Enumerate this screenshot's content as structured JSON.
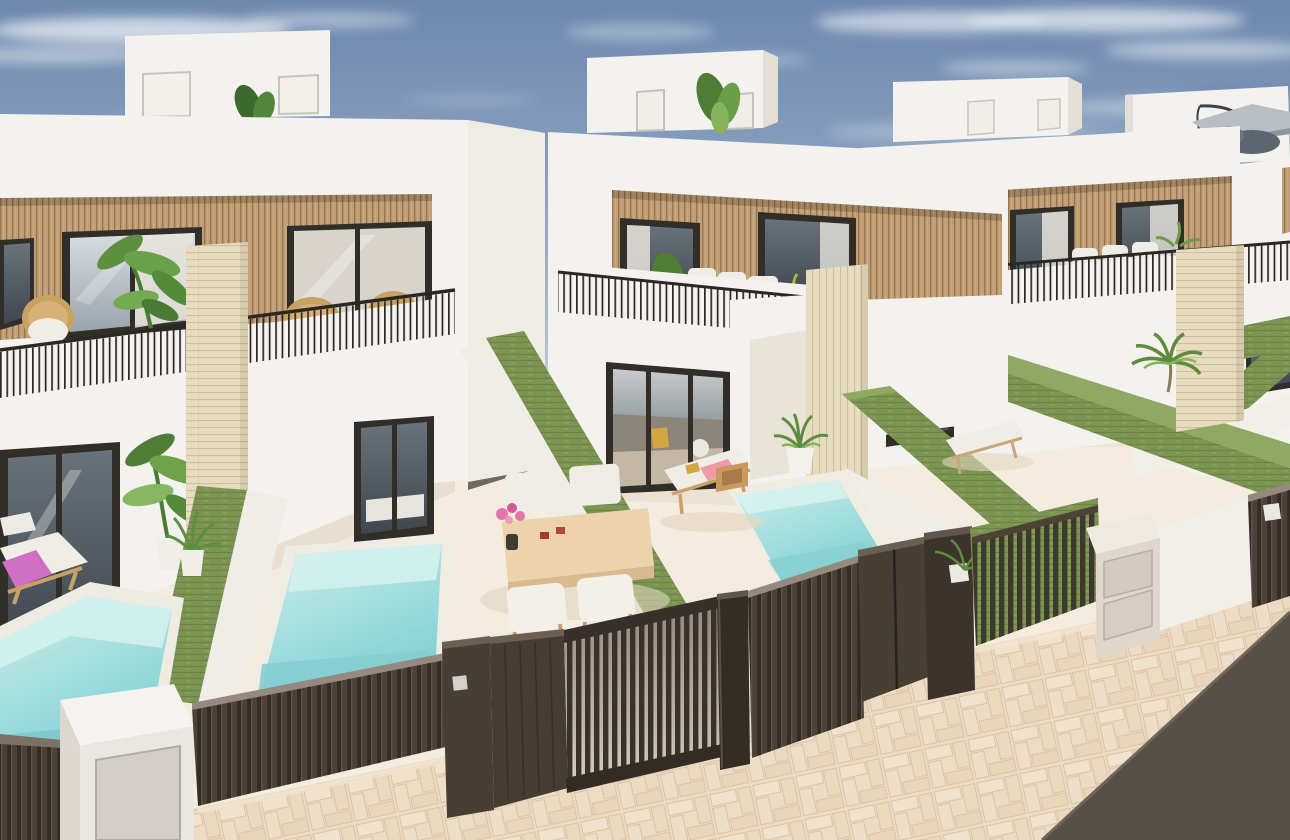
{
  "scene": {
    "type": "3d-architectural-render",
    "subject": "row of modern two-storey white villas with rooftop terraces, wooden slat facades, private plunge pools, green hedge walls, dark slatted street fence and gates, herringbone sidewalk and asphalt road",
    "palette": {
      "sky_top": "#6d88ae",
      "sky_mid": "#93a9c4",
      "sky_horizon": "#cdd4dc",
      "cloud": "#eef2f6",
      "cloud_shadow": "#5f7ba3",
      "wall_white": "#f4f2ee",
      "wall_shadow": "#e3dfd7",
      "wood_slat": "#bf9d75",
      "wood_slat_dark": "#97764f",
      "window_frame": "#312e29",
      "glass_light": "#d8dde1",
      "glass_dark": "#3f464d",
      "curtain": "#e6e3dc",
      "railing": "#2b2824",
      "travertine": "#e7dcc0",
      "travertine_line": "#d0bf9f",
      "hedge": "#7c9452",
      "hedge_dark": "#6a8244",
      "hedge_light": "#8fa964",
      "pool_light": "#cdeeea",
      "pool_deep": "#7fd0d4",
      "patio_floor": "#f3ecdf",
      "fence_dark": "#332c25",
      "fence_slat": "#4b4137",
      "gate_backdrop": "#d7d0c4",
      "metal_panel": "#d2cec7",
      "sidewalk": "#eddbc4",
      "sidewalk_line": "#dcc2a4",
      "asphalt": "#575049",
      "lounger_wood": "#caa06a",
      "cushion_white": "#f0ede6",
      "towel_pink": "#ef9aa6",
      "towel_magenta": "#cf6ec2",
      "plant_green": "#5e8c3c",
      "plant_light": "#86b35c",
      "parasol": "#b9bec5",
      "wicker": "#c9a263",
      "table_wood": "#ecd3ac",
      "flower_pink": "#e577a8",
      "cup_red": "#a8392b",
      "accent_yellow": "#d2a742"
    },
    "elements": [
      "sky",
      "clouds",
      "house-1",
      "house-2",
      "house-3",
      "house-4",
      "rooftop-stair-boxes",
      "roof-parasol",
      "wood-slat-facades",
      "balcony-railings",
      "wicker-chairs",
      "terrace-sofas",
      "travertine-pillars",
      "green-hedge-walls",
      "pool-1",
      "pool-2",
      "pool-3",
      "sun-loungers",
      "outdoor-dining-set",
      "potted-plants",
      "street-fence",
      "pedestrian-door",
      "sliding-gate",
      "letterbox-pillar",
      "gate-pillars",
      "herringbone-sidewalk",
      "asphalt-road"
    ]
  }
}
